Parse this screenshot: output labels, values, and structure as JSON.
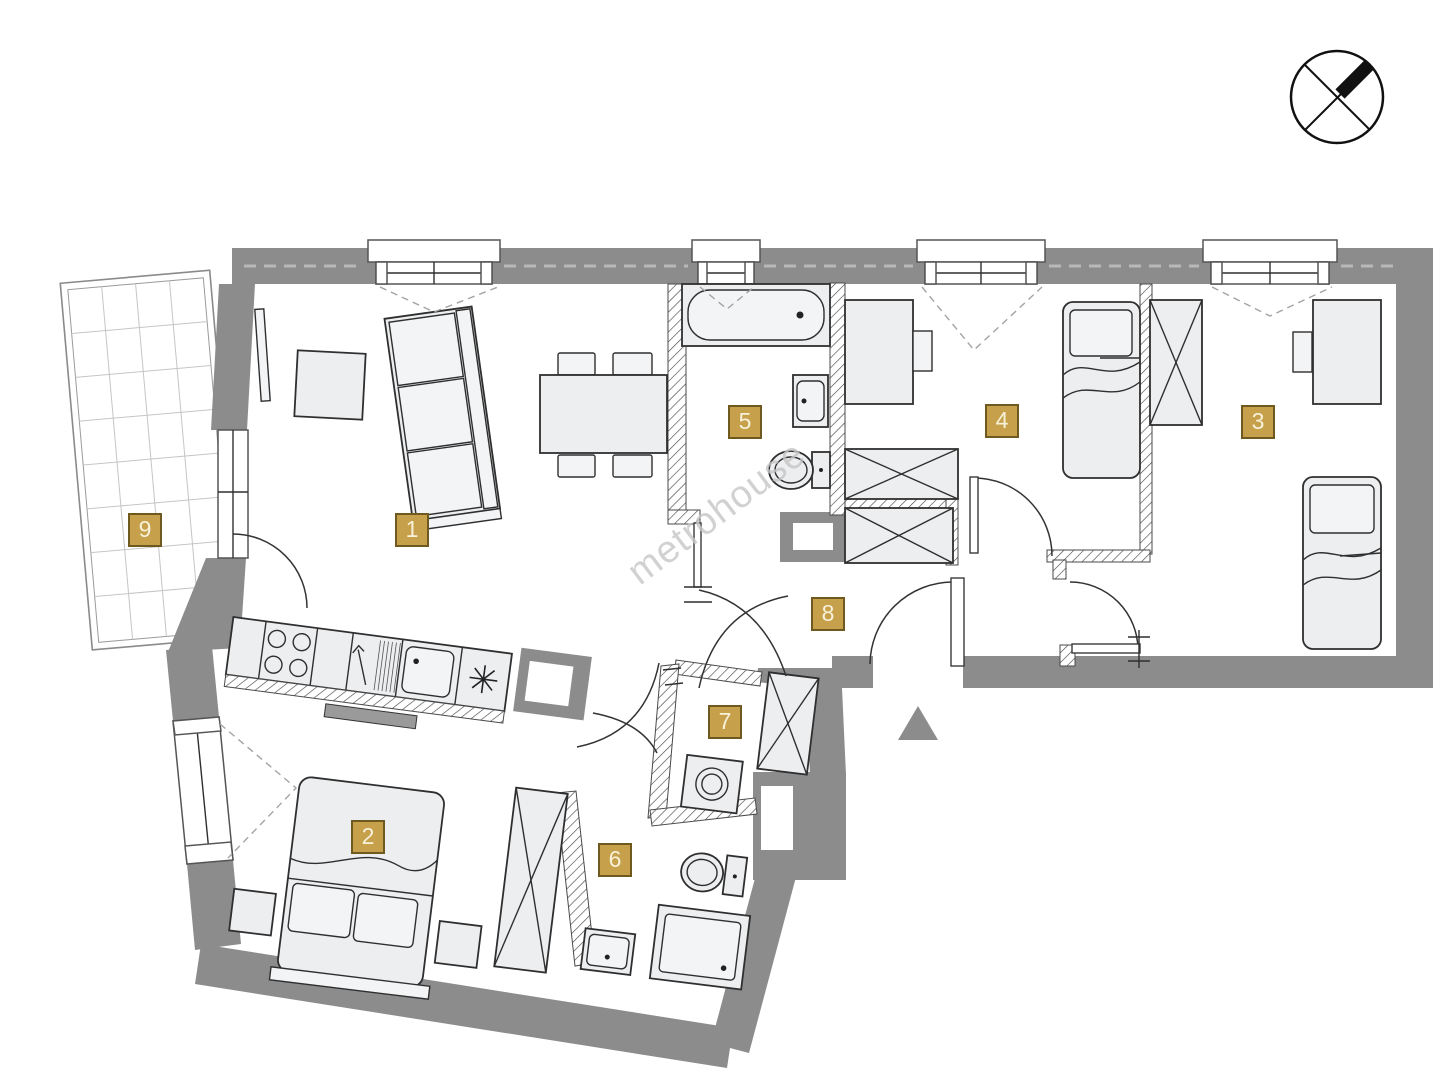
{
  "watermark": "metrohouse",
  "plan": {
    "width": 1443,
    "height": 1080
  },
  "rooms": [
    {
      "number": "1",
      "x": 412,
      "y": 530
    },
    {
      "number": "2",
      "x": 368,
      "y": 837
    },
    {
      "number": "3",
      "x": 1258,
      "y": 422
    },
    {
      "number": "4",
      "x": 1002,
      "y": 421
    },
    {
      "number": "5",
      "x": 745,
      "y": 422
    },
    {
      "number": "6",
      "x": 615,
      "y": 860
    },
    {
      "number": "7",
      "x": 725,
      "y": 722
    },
    {
      "number": "8",
      "x": 828,
      "y": 614
    },
    {
      "number": "9",
      "x": 145,
      "y": 530
    }
  ],
  "colors": {
    "wall": "#8c8c8c",
    "furniture_fill": "#eceef0",
    "outline": "#2f2f2f",
    "badge_fill": "#c6a04a",
    "badge_border": "#6e5a1e",
    "badge_text": "#f8f1da",
    "watermark": "#c6c6c6"
  }
}
